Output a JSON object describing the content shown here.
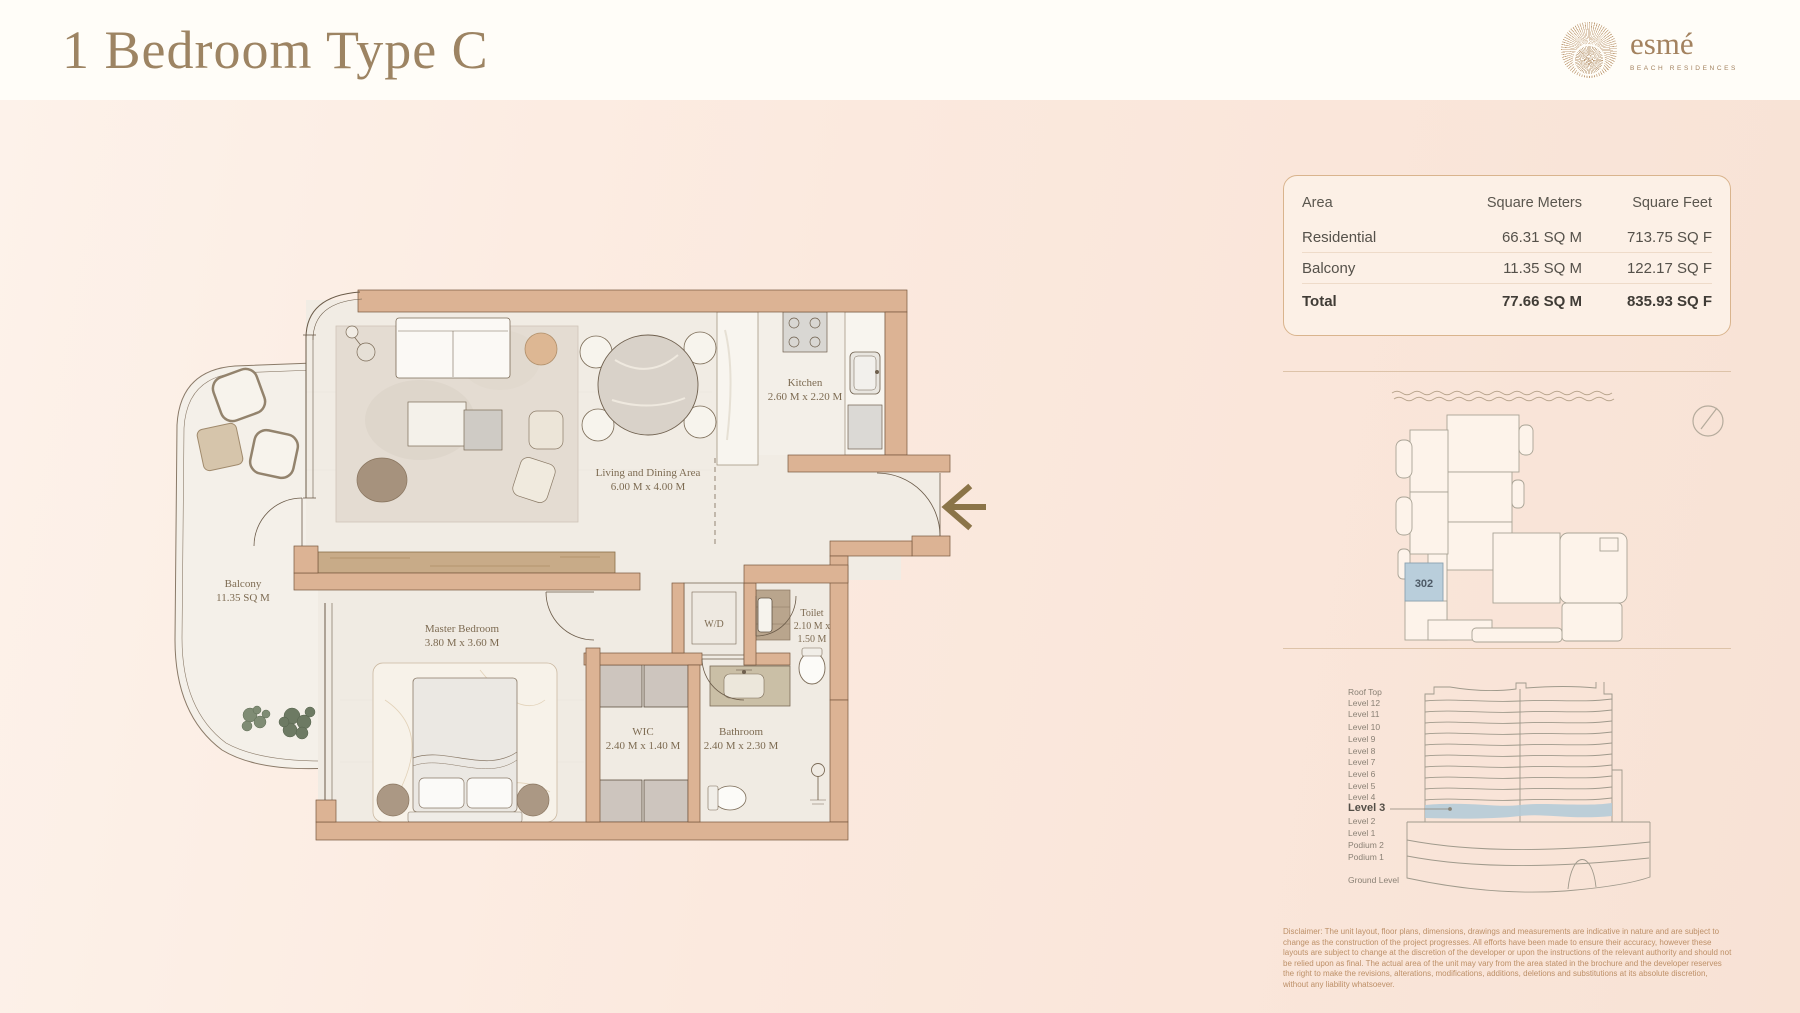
{
  "header": {
    "title": "1 Bedroom Type C",
    "brand": {
      "name": "esmé",
      "tagline": "BEACH RESIDENCES"
    }
  },
  "area_table": {
    "columns": [
      "Area",
      "Square Meters",
      "Square Feet"
    ],
    "rows": [
      {
        "label": "Residential",
        "sqm": "66.31 SQ M",
        "sqf": "713.75 SQ F"
      },
      {
        "label": "Balcony",
        "sqm": "11.35 SQ M",
        "sqf": "122.17 SQ F"
      },
      {
        "label": "Total",
        "sqm": "77.66 SQ M",
        "sqf": "835.93 SQ F"
      }
    ]
  },
  "floor_plan": {
    "rooms": {
      "living": {
        "name": "Living and Dining Area",
        "dims": "6.00 M x 4.00 M"
      },
      "kitchen": {
        "name": "Kitchen",
        "dims": "2.60 M x 2.20 M"
      },
      "master": {
        "name": "Master Bedroom",
        "dims": "3.80 M x 3.60 M"
      },
      "balcony": {
        "name": "Balcony",
        "dims": "11.35 SQ M"
      },
      "wic": {
        "name": "WIC",
        "dims": "2.40 M x 1.40 M"
      },
      "bathroom": {
        "name": "Bathroom",
        "dims": "2.40 M x 2.30 M"
      },
      "toilet": {
        "name": "Toilet",
        "dims_line1": "2.10 M x",
        "dims_line2": "1.50 M"
      },
      "wd": {
        "name": "W/D"
      }
    }
  },
  "key_plan": {
    "unit_number": "302"
  },
  "elevation": {
    "levels": [
      "Roof Top",
      "Level 12",
      "Level 11",
      "Level 10",
      "Level 9",
      "Level 8",
      "Level 7",
      "Level 6",
      "Level 5",
      "Level 4",
      "Level 3",
      "Level 2",
      "Level 1",
      "Podium 2",
      "Podium 1",
      "Ground Level"
    ],
    "highlighted_level": "Level 3"
  },
  "disclaimer": "Disclaimer: The unit layout, floor plans, dimensions, drawings and measurements are indicative in nature and are subject to change as the construction of the project progresses. All efforts have been made to ensure their accuracy, however these layouts are subject to change at the discretion of the developer or upon the instructions of the relevant authority and should not be relied upon as final. The actual area of the unit may vary from the area stated in the brochure and the developer reserves the right to make the revisions, alterations, modifications, additions, deletions and substitutions at its absolute discretion, without any liability whatsoever.",
  "colors": {
    "accent_tan": "#dcb394",
    "highlight_blue": "#b5cbd8",
    "title": "#9d8463"
  }
}
